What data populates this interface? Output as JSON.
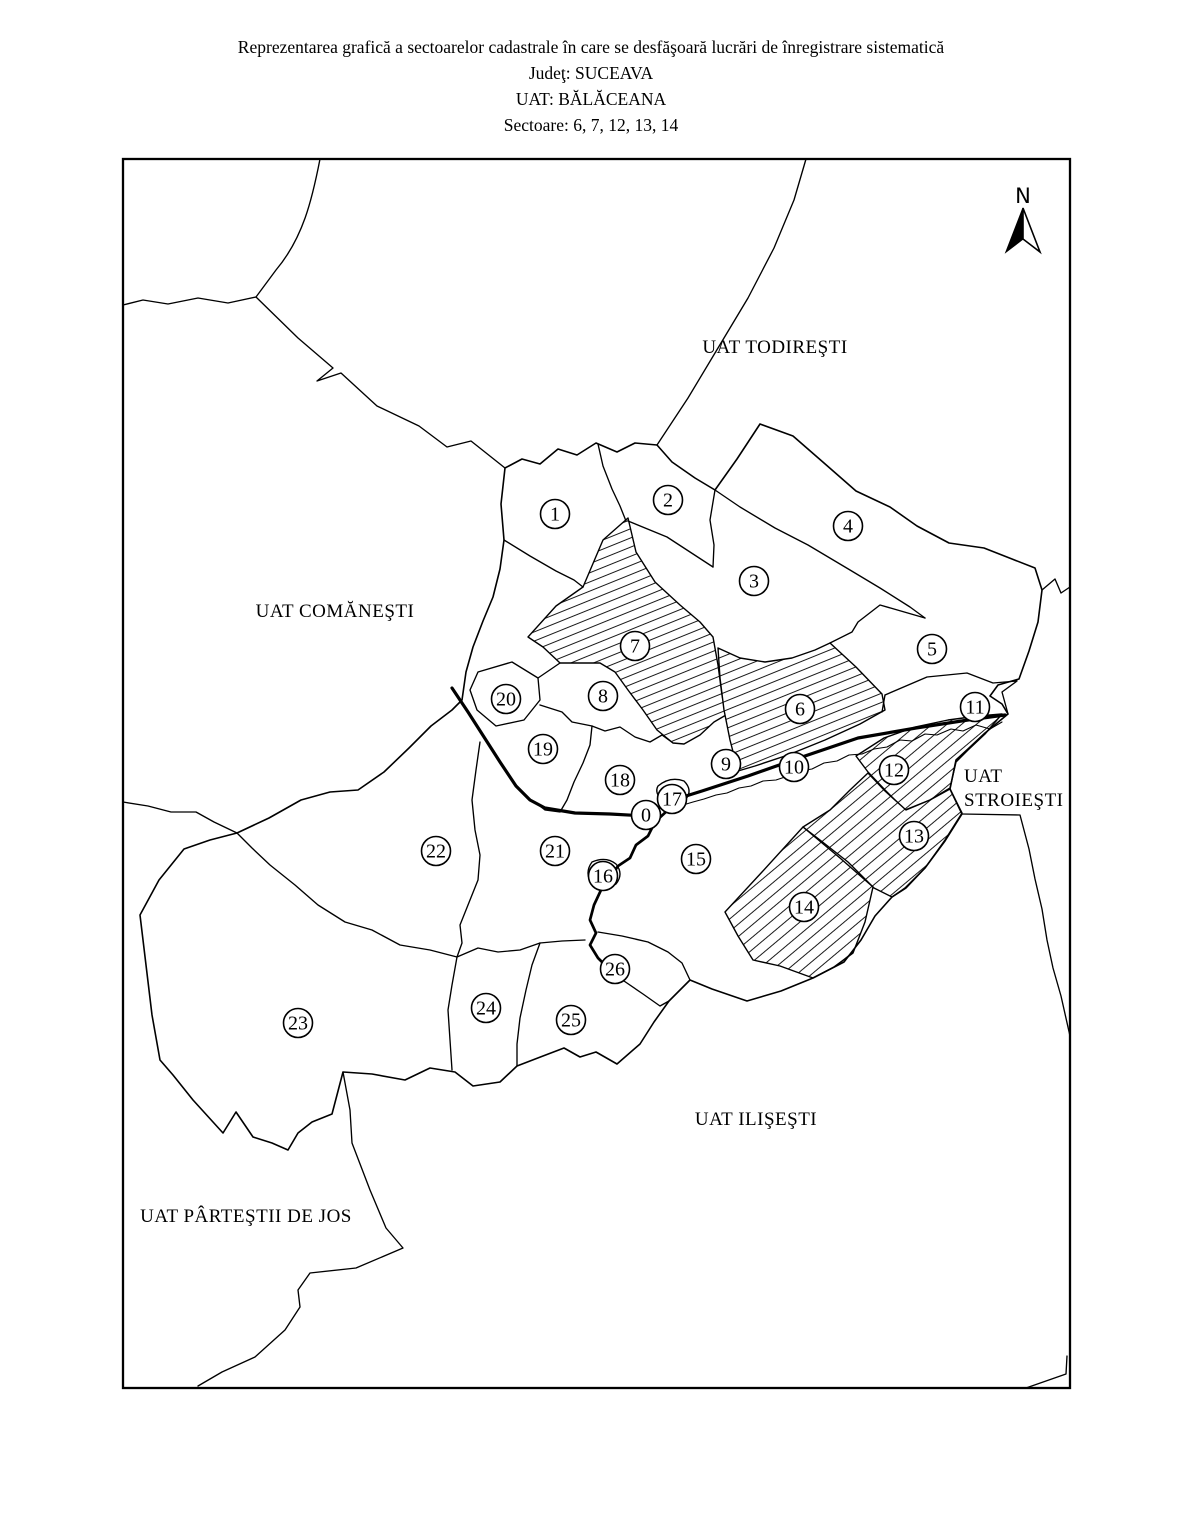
{
  "title": {
    "line1": "Reprezentarea grafică a sectoarelor cadastrale în care se desfăşoară lucrări de înregistrare sistematică",
    "judet_line": "Judeţ: SUCEAVA",
    "uat_line": "UAT: BĂLĂCEANA",
    "sectors_line": "Sectoare: 6, 7, 12, 13, 14"
  },
  "map": {
    "north_label": "N",
    "neighbor_labels": [
      {
        "id": "todiresti",
        "text": "UAT TODIREŞTI",
        "x": 775,
        "y": 353,
        "anchor": "middle"
      },
      {
        "id": "comanesti",
        "text": "UAT COMĂNEŞTI",
        "x": 335,
        "y": 617,
        "anchor": "middle"
      },
      {
        "id": "stroiesti-line1",
        "text": "UAT",
        "x": 964,
        "y": 782,
        "anchor": "start"
      },
      {
        "id": "stroiesti-line2",
        "text": "STROIEŞTI",
        "x": 964,
        "y": 806,
        "anchor": "start"
      },
      {
        "id": "ilisesti",
        "text": "UAT ILIŞEŞTI",
        "x": 756,
        "y": 1125,
        "anchor": "middle"
      },
      {
        "id": "partestii-de-jos",
        "text": "UAT PÂRTEŞTII DE JOS",
        "x": 246,
        "y": 1222,
        "anchor": "middle"
      }
    ],
    "highlighted_sectors": "6, 7, 12, 13, 14",
    "sector_markers": [
      {
        "label": "0",
        "x": 646,
        "y": 815,
        "hatched": false
      },
      {
        "label": "1",
        "x": 555,
        "y": 514,
        "hatched": false
      },
      {
        "label": "2",
        "x": 668,
        "y": 500,
        "hatched": false
      },
      {
        "label": "3",
        "x": 754,
        "y": 581,
        "hatched": false
      },
      {
        "label": "4",
        "x": 848,
        "y": 526,
        "hatched": false
      },
      {
        "label": "5",
        "x": 932,
        "y": 649,
        "hatched": false
      },
      {
        "label": "6",
        "x": 800,
        "y": 709,
        "hatched": true
      },
      {
        "label": "7",
        "x": 635,
        "y": 646,
        "hatched": true
      },
      {
        "label": "8",
        "x": 603,
        "y": 696,
        "hatched": false
      },
      {
        "label": "9",
        "x": 726,
        "y": 764,
        "hatched": false
      },
      {
        "label": "10",
        "x": 794,
        "y": 767,
        "hatched": false
      },
      {
        "label": "11",
        "x": 975,
        "y": 707,
        "hatched": false
      },
      {
        "label": "12",
        "x": 894,
        "y": 770,
        "hatched": true
      },
      {
        "label": "13",
        "x": 914,
        "y": 836,
        "hatched": true
      },
      {
        "label": "14",
        "x": 804,
        "y": 907,
        "hatched": true
      },
      {
        "label": "15",
        "x": 696,
        "y": 859,
        "hatched": false
      },
      {
        "label": "16",
        "x": 603,
        "y": 876,
        "hatched": false
      },
      {
        "label": "17",
        "x": 672,
        "y": 799,
        "hatched": false
      },
      {
        "label": "18",
        "x": 620,
        "y": 780,
        "hatched": false
      },
      {
        "label": "19",
        "x": 543,
        "y": 749,
        "hatched": false
      },
      {
        "label": "20",
        "x": 506,
        "y": 699,
        "hatched": false
      },
      {
        "label": "21",
        "x": 555,
        "y": 851,
        "hatched": false
      },
      {
        "label": "22",
        "x": 436,
        "y": 851,
        "hatched": false
      },
      {
        "label": "23",
        "x": 298,
        "y": 1023,
        "hatched": false
      },
      {
        "label": "24",
        "x": 486,
        "y": 1008,
        "hatched": false
      },
      {
        "label": "25",
        "x": 571,
        "y": 1020,
        "hatched": false
      },
      {
        "label": "26",
        "x": 615,
        "y": 969,
        "hatched": false
      }
    ]
  },
  "colors": {
    "line": "#000000",
    "background": "#ffffff"
  }
}
